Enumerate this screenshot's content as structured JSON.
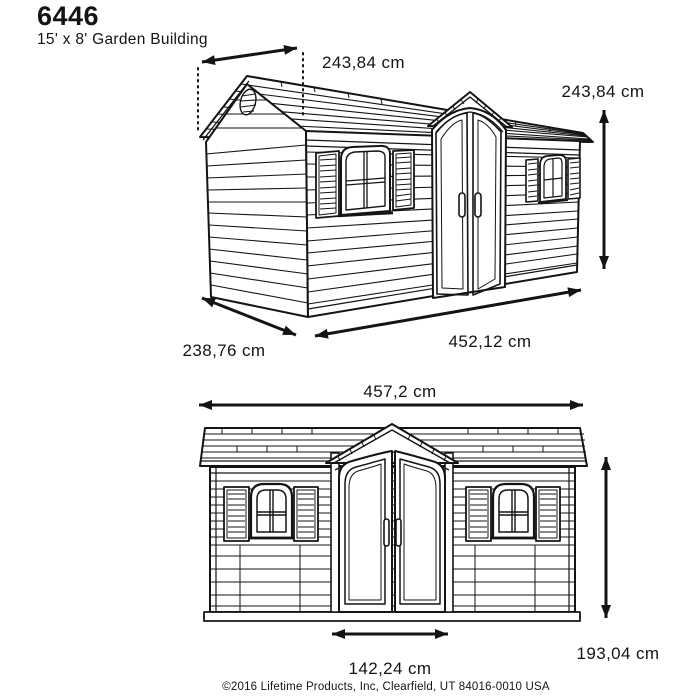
{
  "page": {
    "title": "6446",
    "subtitle": "15' x 8' Garden Building"
  },
  "perspective_view": {
    "dim_roof_width": "243,84 cm",
    "dim_height": "243,84 cm",
    "dim_depth": "238,76 cm",
    "dim_length": "452,12 cm"
  },
  "front_view": {
    "dim_width": "457,2 cm",
    "dim_height": "193,04 cm",
    "dim_door_width": "142,24 cm"
  },
  "footer": {
    "copyright": "©2016 Lifetime Products, Inc, Clearfield, UT 84016-0010 USA"
  },
  "colors": {
    "line": "#141414",
    "background": "#ffffff"
  }
}
